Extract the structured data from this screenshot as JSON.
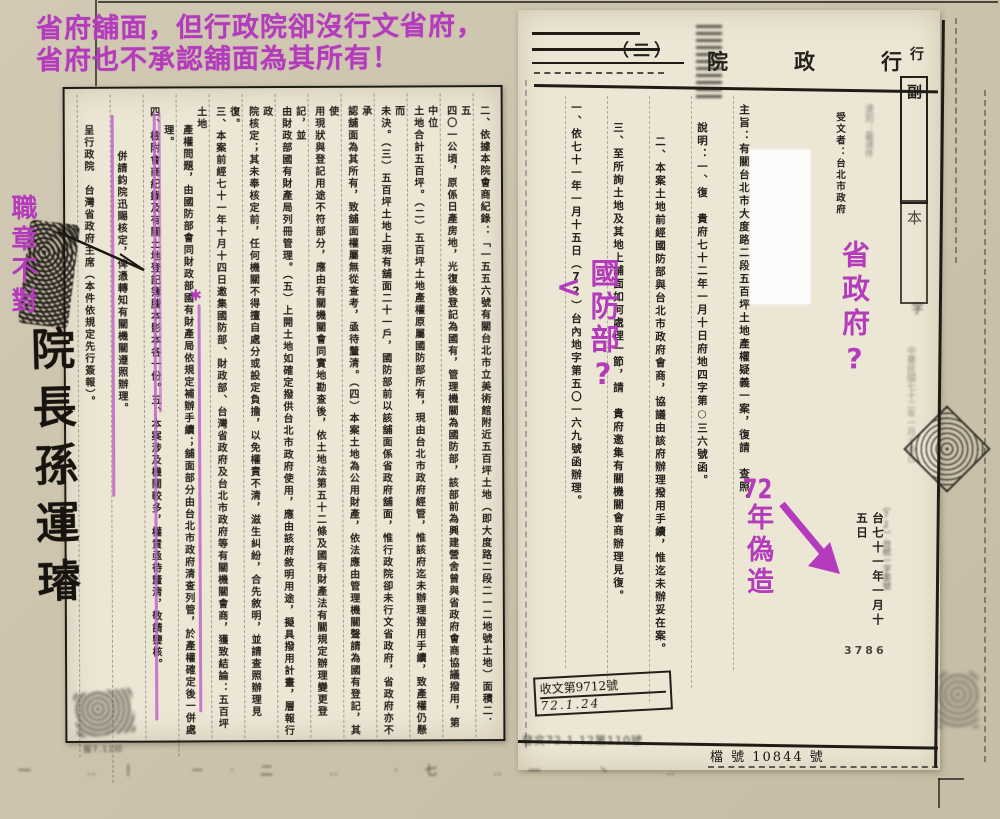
{
  "colors": {
    "accent_magenta": "#b43cbc",
    "ink": "#24201c",
    "paper": "#ece6d4",
    "backdrop": "#cdc4ae"
  },
  "annotations": {
    "top_note_line1": "省府舖面，但行政院卻沒行文省府，",
    "top_note_line2": "省府也不承認舖面為其所有！",
    "left_note": "職章不對",
    "signature": "院長孫運璿",
    "mid_arrow": "<",
    "mid_note": "國防部?",
    "right_note": "省政府?",
    "forged_note_num": "72",
    "forged_note_rest": "年偽造",
    "column_star": "✱"
  },
  "left_page": {
    "columns": [
      {
        "text": "二、依據本院會商紀錄：「一五五六號有關台北市立美術館附近五百坪土地（即大度路二段二一二地號土地）面積二．五",
        "indent": 12
      },
      {
        "text": "四〇一公頃，原係日產房地，光復後登記為國有，管理機關為國防部，該部前為興建營舍曾與省政府會商協議撥用，第中位",
        "indent": 12
      },
      {
        "text": "土地合計五百坪。（二）五百坪土地產權原屬國防部所有，現由台北市政府經管，惟該府迄未辦理撥用手續，致產權仍懸而",
        "indent": 12
      },
      {
        "text": "未決。（三）五百坪土地上現有舖面二十一戶，國防部前以該舖面係省政府舖面，惟行政院卻未行文省政府，省政府亦不承",
        "indent": 12
      },
      {
        "text": "認舖面為其所有，致舖面權屬無從查考，亟待釐清。（四）本案土地為公用財產，依法應由管理機關聲請為國有登記，其使",
        "indent": 12
      },
      {
        "text": "用現狀與登記用途不符部分，應由有關機關會同實地勘查後，依土地法第五十二條及國有財產法有關規定辦理變更登記，並",
        "indent": 12
      },
      {
        "text": "由財政部國有財產局列冊管理。（五）上開土地如確定撥供台北市政府使用，應由該府敘明用途，擬具撥用計畫，層報行政",
        "indent": 12
      },
      {
        "text": "院核定；其未奉核定前，任何機關不得擅自處分或設定負擔，以免權責不清，滋生糾紛，合先敘明，並請查照辦理見復。",
        "indent": 12
      },
      {
        "text": "三、本案前經七十一年十月十四日邀集國防部、財政部、台灣省政府及台北市政府等有關機關會商，獲致結論：五百坪土地",
        "indent": 12
      },
      {
        "text": "產權問題，由國防部會同財政部國有財產局依規定補辦手續；舖面部分由台北市政府清查列管，於產權確定後一併處理。",
        "indent": 30
      },
      {
        "text": "四、檢附會商紀錄及有關土地登記簿謄本影本各一份。五、本案涉及機關較多，權責亟待釐清，敬請鑒核。",
        "indent": 12
      },
      {
        "text": "併請鈞院迅賜核定，俾憑轉知有關機關遵照辦理。",
        "indent": 56
      },
      {
        "text": "呈行政院　台灣省政府主席（本件依規定先行簽報）。",
        "indent": 30
      }
    ],
    "footer_note": "服7.12印"
  },
  "right_page": {
    "title_chars": [
      "行",
      "政",
      "院"
    ],
    "paren_label": "（二）",
    "copy_stamp_top": "副",
    "copy_stamp_bottom": "本",
    "copy_stamp_tail": "字",
    "recipient_col": "受文者：台北市政府",
    "speed_col": "速別：最速件",
    "columns": [
      {
        "text": "主旨：有關台北市大度路二段五百坪土地產權疑義一案，復請　查照。",
        "indent": 8
      },
      {
        "text": "說明：一、復　貴府七十二年一月十日府地四字第○三六號函。",
        "indent": 26
      },
      {
        "text": "二、本案土地前經國防部與台北市政府會商，協議由該府辦理撥用手續，惟迄未辦妥在案。",
        "indent": 40
      },
      {
        "text": "三、至所詢土地及其地上舖面如何處理一節，請　貴府邀集有關機關會商辦理見復。",
        "indent": 26
      },
      {
        "text": "一、依七十一年一月十五日（72）台內地字第五〇一六九號函辦理。",
        "indent": 6
      }
    ],
    "date_col": "台七十一年一月十五日",
    "ref_col": "（72）台統一字第號",
    "serial_number": "3786",
    "faint_right_col": "中華民國七十二年一月十四日",
    "stamp_box_line1": "收文第9712號",
    "stamp_box_line2": "72.1.24",
    "bottom_stamp_left": "發文72.1.12第110號",
    "bottom_stamp_right": "檔 號 10844 號",
    "debris_row": "一 ‥丨 ㄧ·二 ‥ ·七 ‥一 丶 ‥"
  }
}
